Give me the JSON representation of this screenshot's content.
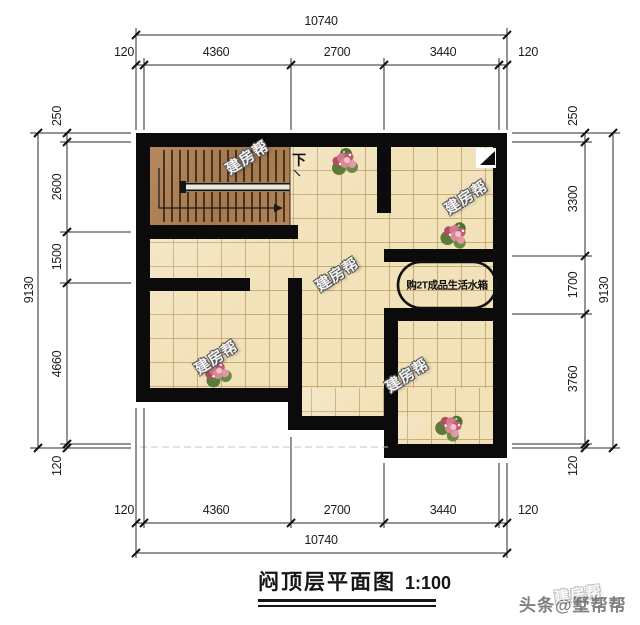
{
  "title": {
    "name": "闷顶层平面图",
    "scale": "1:100"
  },
  "brand": "头条@墅帮帮",
  "watermark_text": "建房帮",
  "plan": {
    "stair_down_label": "下",
    "water_tank_label": "购2T成品生活水箱"
  },
  "dimensions": {
    "top": {
      "overall": "10740",
      "segments": [
        "120",
        "4360",
        "2700",
        "3440",
        "120"
      ]
    },
    "bottom": {
      "overall": "10740",
      "segments": [
        "120",
        "4360",
        "2700",
        "3440",
        "120"
      ]
    },
    "left": {
      "overall": "9130",
      "segments": [
        "250",
        "2600",
        "1500",
        "4660",
        "120"
      ]
    },
    "right": {
      "overall": "9130",
      "segments": [
        "250",
        "3300",
        "1700",
        "3760",
        "120"
      ]
    }
  },
  "colors": {
    "wall": "#0b0b0b",
    "tile_fill": "#f2e2ba",
    "tile_grid": "#c9ab76",
    "stair_floor": "#ae8055",
    "dimension_line": "#2a2a2a",
    "brand_text": "#7f7f7f"
  }
}
